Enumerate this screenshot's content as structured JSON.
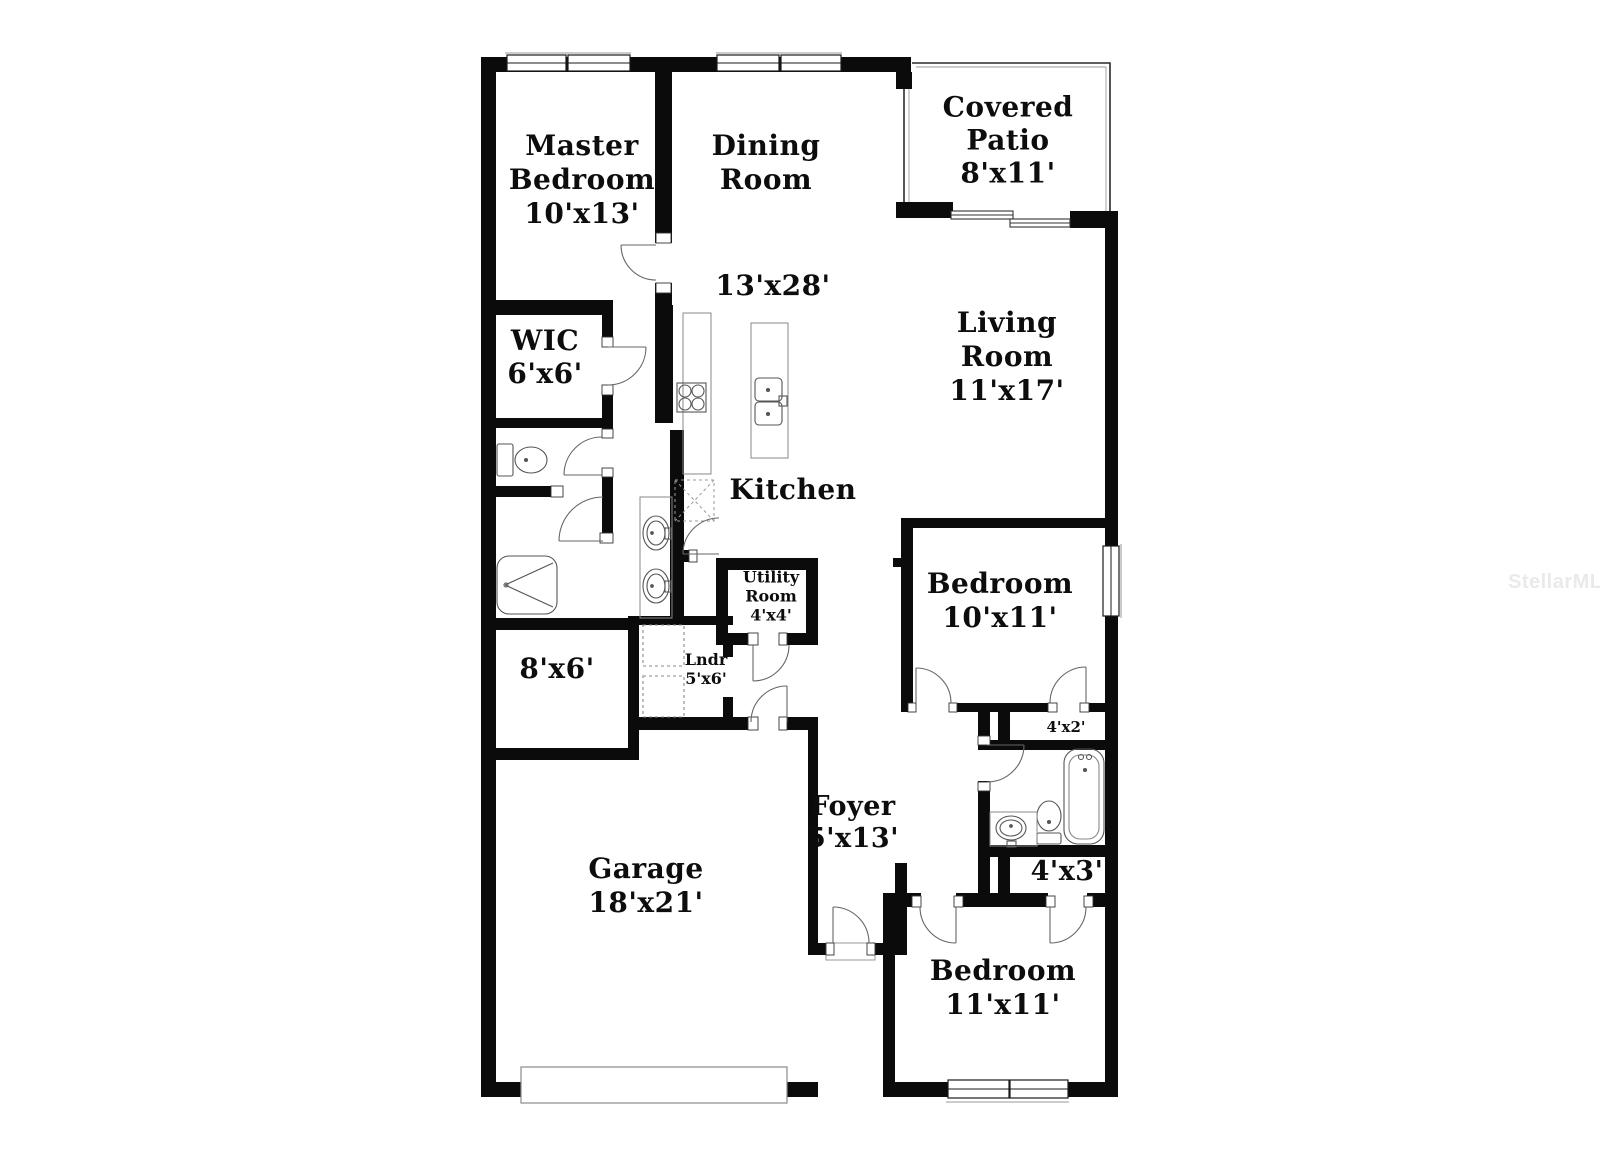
{
  "floor_plan": {
    "watermark": "StellarMLS",
    "colors": {
      "wall": "#0b0b0b",
      "fixture": "#555555",
      "counter": "#8a8a8a",
      "watermark": "#eaeaea"
    },
    "labels": [
      {
        "id": "master-bedroom",
        "lines": [
          "Master",
          "Bedroom",
          "10'x13'"
        ]
      },
      {
        "id": "dining-room",
        "lines": [
          "Dining",
          "Room"
        ]
      },
      {
        "id": "kitchen-dining-dims",
        "lines": [
          "13'x28'"
        ]
      },
      {
        "id": "covered-patio",
        "lines": [
          "Covered",
          "Patio",
          "8'x11'"
        ]
      },
      {
        "id": "living-room",
        "lines": [
          "Living",
          "Room",
          "11'x17'"
        ]
      },
      {
        "id": "wic",
        "lines": [
          "WIC",
          "6'x6'"
        ]
      },
      {
        "id": "kitchen",
        "lines": [
          "Kitchen"
        ]
      },
      {
        "id": "utility-room",
        "lines": [
          "Utility",
          "Room",
          "4'x4'"
        ]
      },
      {
        "id": "laundry",
        "lines": [
          "Lndr",
          "5'x6'"
        ]
      },
      {
        "id": "flex-space",
        "lines": [
          "8'x6'"
        ]
      },
      {
        "id": "bedroom-1",
        "lines": [
          "Bedroom",
          "10'x11'"
        ]
      },
      {
        "id": "closet-4x2",
        "lines": [
          "4'x2'"
        ]
      },
      {
        "id": "foyer",
        "lines": [
          "Foyer",
          "5'x13'"
        ]
      },
      {
        "id": "closet-4x3",
        "lines": [
          "4'x3'"
        ]
      },
      {
        "id": "garage",
        "lines": [
          "Garage",
          "18'x21'"
        ]
      },
      {
        "id": "bedroom-2",
        "lines": [
          "Bedroom",
          "11'x11'"
        ]
      }
    ]
  }
}
